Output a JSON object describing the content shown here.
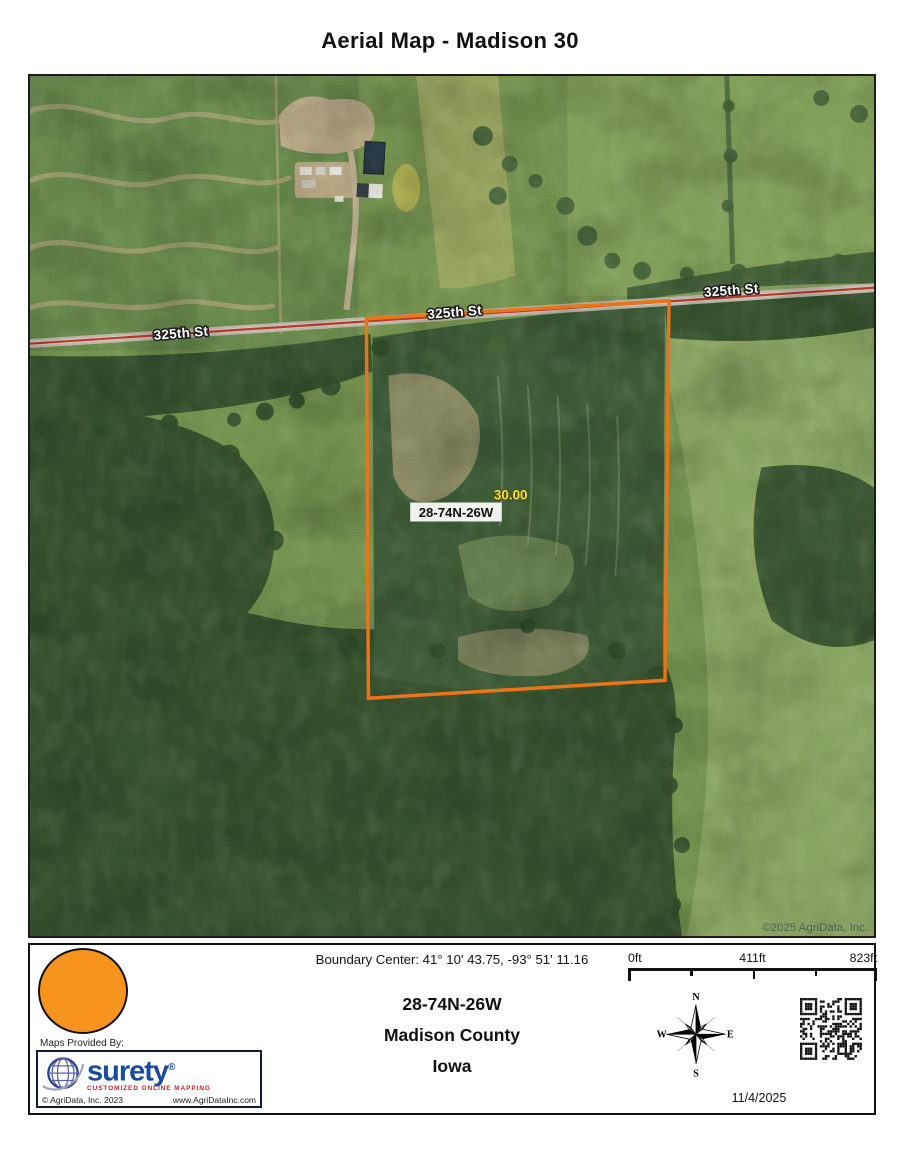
{
  "title": "Aerial Map - Madison 30",
  "map": {
    "road_label": "325th St",
    "parcel_label": "28-74N-26W",
    "acreage_label": "30.00",
    "copyright": "©2025 AgriData, Inc.",
    "boundary_color": "#ec7418",
    "acreage_label_color": "#f2e437"
  },
  "footer": {
    "boundary_center_label": "Boundary Center: 41° 10' 43.75,  -93° 51' 11.16",
    "parcel_id": "28-74N-26W",
    "county": "Madison County",
    "state": "Iowa",
    "scale_labels": {
      "zero": "0ft",
      "mid": "411ft",
      "max": "823ft"
    },
    "compass": {
      "north": "N",
      "east": "E",
      "south": "S",
      "west": "W"
    },
    "date": "11/4/2025",
    "legend_marker_color": "#F7941E",
    "provider": {
      "caption": "Maps Provided By:",
      "brand": "surety",
      "registered_mark": "®",
      "tagline": "CUSTOMIZED ONLINE MAPPING",
      "copyright": "© AgriData, Inc. 2023",
      "website": "www.AgriDataInc.com"
    }
  }
}
